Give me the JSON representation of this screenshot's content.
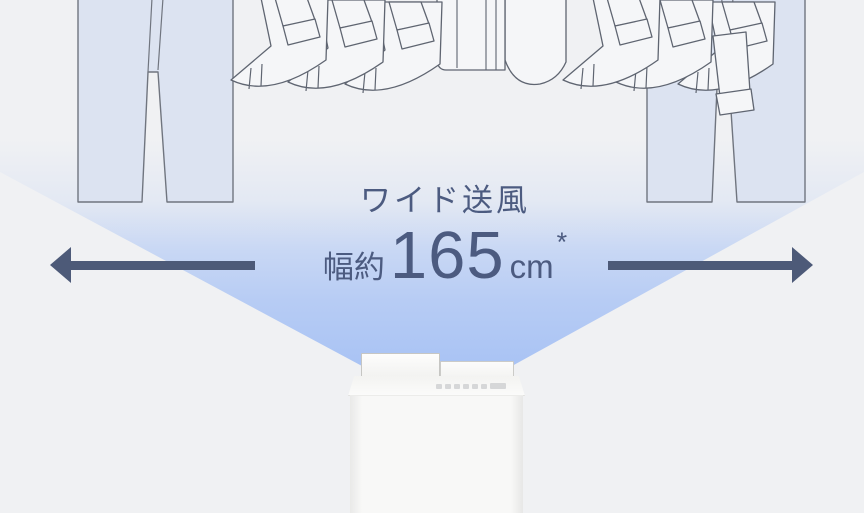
{
  "scene": {
    "airflow_label": "ワイド送風",
    "width_spec": {
      "prefix": "幅約",
      "value": "165",
      "unit": "cm",
      "footnote_marker": "*"
    }
  },
  "icons": {
    "left_arrow": "left-arrow-icon",
    "right_arrow": "right-arrow-icon",
    "laundry": "hanging-laundry-illustration",
    "appliance": "dehumidifier-illustration"
  },
  "colors": {
    "background": "#f0f1f3",
    "fan_blue": "#a9c3f4",
    "arrow_navy": "#4d5a78",
    "text_slate": "#4c5b80",
    "pants_fill": "#dce3f1",
    "shirt_fill": "#f5f6f8",
    "outline_gray": "#5f6571",
    "appliance_white": "#f8f8f7"
  }
}
